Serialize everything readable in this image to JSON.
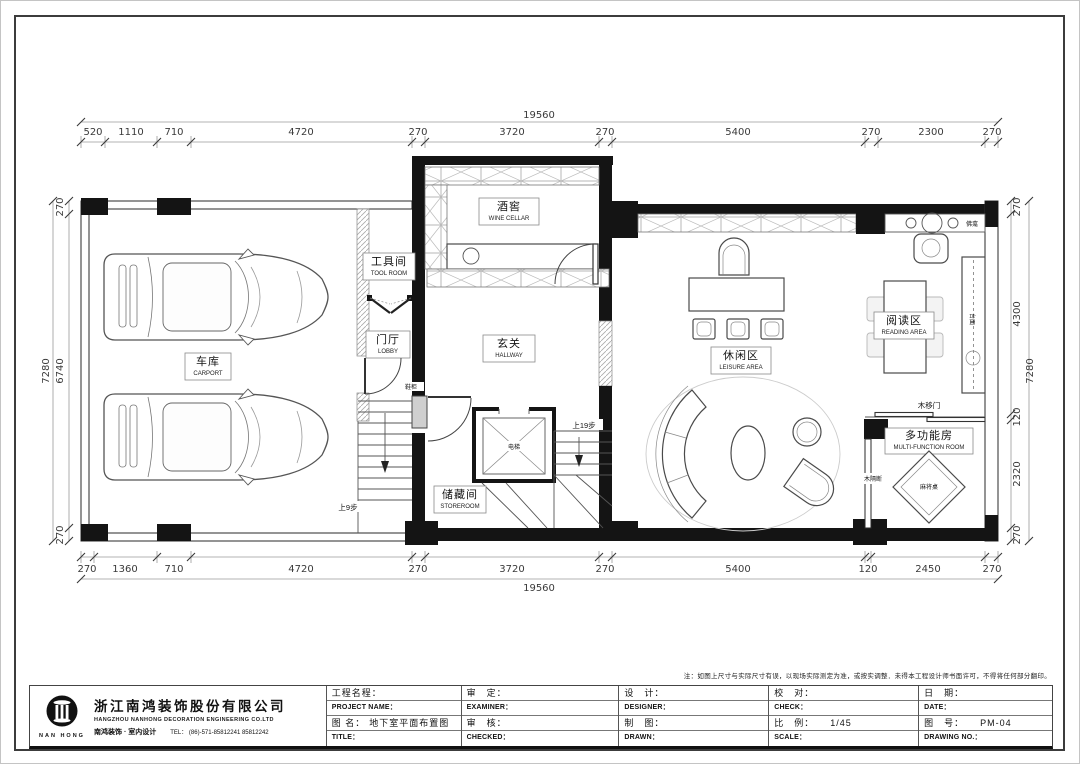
{
  "dimensions": {
    "top": {
      "total": "19560",
      "segments": [
        "520",
        "1110",
        "710",
        "4720",
        "270",
        "3720",
        "270",
        "5400",
        "270",
        "2300",
        "270"
      ]
    },
    "bottom": {
      "total": "19560",
      "segments": [
        "270",
        "1360",
        "710",
        "4720",
        "270",
        "3720",
        "270",
        "5400",
        "120",
        "2450",
        "270"
      ]
    },
    "left": {
      "total": "7280",
      "segments": [
        "270",
        "6740",
        "270"
      ]
    },
    "right": {
      "total": "7280",
      "segments": [
        "270",
        "4300",
        "120",
        "2320",
        "270"
      ]
    }
  },
  "rooms": {
    "carport": {
      "cn": "车库",
      "en": "CARPORT"
    },
    "tool_room": {
      "cn": "工具间",
      "en": "TOOL ROOM"
    },
    "lobby": {
      "cn": "门厅",
      "en": "LOBBY"
    },
    "wine_cellar": {
      "cn": "酒窖",
      "en": "WINE CELLAR"
    },
    "hallway": {
      "cn": "玄关",
      "en": "HALLWAY"
    },
    "storeroom": {
      "cn": "储藏间",
      "en": "STOREROOM"
    },
    "leisure": {
      "cn": "休闲区",
      "en": "LEISURE AREA"
    },
    "reading": {
      "cn": "阅读区",
      "en": "READING AREA"
    },
    "multi_function": {
      "cn": "多功能房",
      "en": "MULTI-FUNCTION ROOM"
    }
  },
  "annotations": {
    "elevator": "电梯",
    "shoe_cabinet": "鞋柜",
    "up_9_steps": "上9步",
    "up_19_steps": "上19步",
    "counter_top": "台面",
    "buddhist_niche": "佛龛",
    "wood_sliding_door": "木移门",
    "wood_partition": "木隔断",
    "mahjong_table": "麻将桌"
  },
  "title_block": {
    "note": "注：如图上尺寸与实际尺寸有误，以现场实际测定为准，或按实调整．未得本工程设计师书面许可，不得将任何部分翻印。",
    "company": {
      "logo_text": "NAN HONG",
      "name_cn": "浙江南鸿装饰股份有限公司",
      "name_en": "HANGZHOU  NANHONG  DECORATION  ENGINEERING  CO.LTD",
      "slogan": "南鸿装饰 · 室内设计",
      "tel": "TEL：  (86)-571-85812241   85812242"
    },
    "fields": {
      "project_name_cn": "工程名程：",
      "project_name_en": "PROJECT NAME：",
      "drawing_name_cn": "图 名：",
      "drawing_name_value": "地下室平面布置图",
      "drawing_name_en": "TITLE：",
      "examine_cn": "审　定：",
      "examine_en": "EXAMINER：",
      "check2_cn": "审　核：",
      "check2_en": "CHECKED：",
      "design_cn": "设　计：",
      "design_en": "DESIGNER：",
      "draw_cn": "制　图：",
      "draw_en": "DRAWN：",
      "proof_cn": "校　对：",
      "proof_en": "CHECK：",
      "scale_cn": "比　例：",
      "scale_value": "1/45",
      "scale_en": "SCALE：",
      "date_cn": "日　期：",
      "date_en": "DATE：",
      "no_cn": "图　号：",
      "no_value": "PM-04",
      "no_en": "DRAWING NO.："
    }
  }
}
